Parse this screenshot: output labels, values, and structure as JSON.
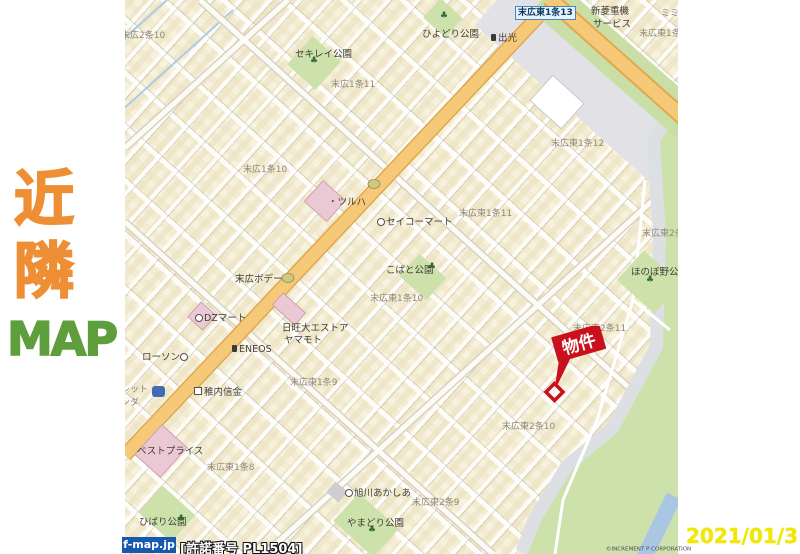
{
  "colors": {
    "orange": "#ee8f35",
    "green": "#5f9e3c",
    "dateyellow": "#f0e70c",
    "propertyred": "#c9101c",
    "fmapblue": "#1859b0",
    "roadyellow": "#f6c979",
    "parkgreen": "#cde1ab"
  },
  "sidebar": {
    "line1": "近",
    "line2": "隣",
    "line3": "MAP"
  },
  "date_stamp": "2021/01/31",
  "attribution": {
    "site": "f-map.jp",
    "license": "[許諾番号 PL1504]",
    "copyright": "©INCREMENT P CORPORATION"
  },
  "map": {
    "road_sign": {
      "text": "末広東1条13"
    },
    "property": {
      "label": "物件"
    },
    "park_icon_glyph": "♣",
    "area_labels": [
      {
        "text": "末広2条10",
        "x": -4,
        "y": 28
      },
      {
        "text": "末広1条11",
        "x": 206,
        "y": 77
      },
      {
        "text": "末広1条10",
        "x": 118,
        "y": 162
      },
      {
        "text": "末広東1条12",
        "x": 426,
        "y": 136
      },
      {
        "text": "末広東1条11",
        "x": 334,
        "y": 206
      },
      {
        "text": "末広東1条10",
        "x": 245,
        "y": 291
      },
      {
        "text": "末広東2条",
        "x": 517,
        "y": 226
      },
      {
        "text": "末広東2条11",
        "x": 448,
        "y": 321
      },
      {
        "text": "末広東1条9",
        "x": 165,
        "y": 375
      },
      {
        "text": "末広東2条10",
        "x": 377,
        "y": 419
      },
      {
        "text": "末広東1条8",
        "x": 82,
        "y": 460
      },
      {
        "text": "末広東2条9",
        "x": 287,
        "y": 495
      },
      {
        "text": "末広東1条1",
        "x": 514,
        "y": 26
      },
      {
        "text": "ミミ",
        "x": 536,
        "y": 6
      },
      {
        "text": "レット",
        "x": -4,
        "y": 382
      },
      {
        "text": "ンダ",
        "x": -4,
        "y": 395
      }
    ],
    "poi_labels": [
      {
        "text": "セキレイ公園",
        "x": 170,
        "y": 46
      },
      {
        "text": "ひよどり公園",
        "x": 297,
        "y": 26
      },
      {
        "text": "出光",
        "x": 366,
        "y": 30,
        "icon": "gas"
      },
      {
        "text": "新菱重機",
        "x": 466,
        "y": 3
      },
      {
        "text": "サービス",
        "x": 468,
        "y": 16
      },
      {
        "text": "ツルハ",
        "x": 203,
        "y": 194,
        "icon": "dot"
      },
      {
        "text": "セイコーマート",
        "x": 252,
        "y": 214,
        "icon": "circle"
      },
      {
        "text": "こばと公園",
        "x": 261,
        "y": 262
      },
      {
        "text": "末広ボデー",
        "x": 110,
        "y": 271
      },
      {
        "text": "ほのぼ野公園",
        "x": 506,
        "y": 264
      },
      {
        "text": "DZマート",
        "x": 70,
        "y": 310,
        "icon": "circle"
      },
      {
        "text": "日旺大エストア",
        "x": 157,
        "y": 320
      },
      {
        "text": "ヤマモト",
        "x": 159,
        "y": 332
      },
      {
        "text": "ENEOS",
        "x": 107,
        "y": 344,
        "icon": "gas"
      },
      {
        "text": "ローソン",
        "x": 17,
        "y": 349,
        "icon_after": "circle"
      },
      {
        "text": "稚内信金",
        "x": 69,
        "y": 384,
        "icon": "square"
      },
      {
        "text": "ベストプライス",
        "x": 12,
        "y": 443
      },
      {
        "text": "ひばり公園",
        "x": 14,
        "y": 514
      },
      {
        "text": "旭川あかしあ",
        "x": 220,
        "y": 485,
        "icon": "circle"
      },
      {
        "text": "やまどり公園",
        "x": 222,
        "y": 515
      }
    ],
    "park_icons": [
      {
        "x": 185,
        "y": 57
      },
      {
        "x": 315,
        "y": 12
      },
      {
        "x": 303,
        "y": 263
      },
      {
        "x": 521,
        "y": 276
      },
      {
        "x": 52,
        "y": 515
      },
      {
        "x": 243,
        "y": 526
      }
    ]
  }
}
